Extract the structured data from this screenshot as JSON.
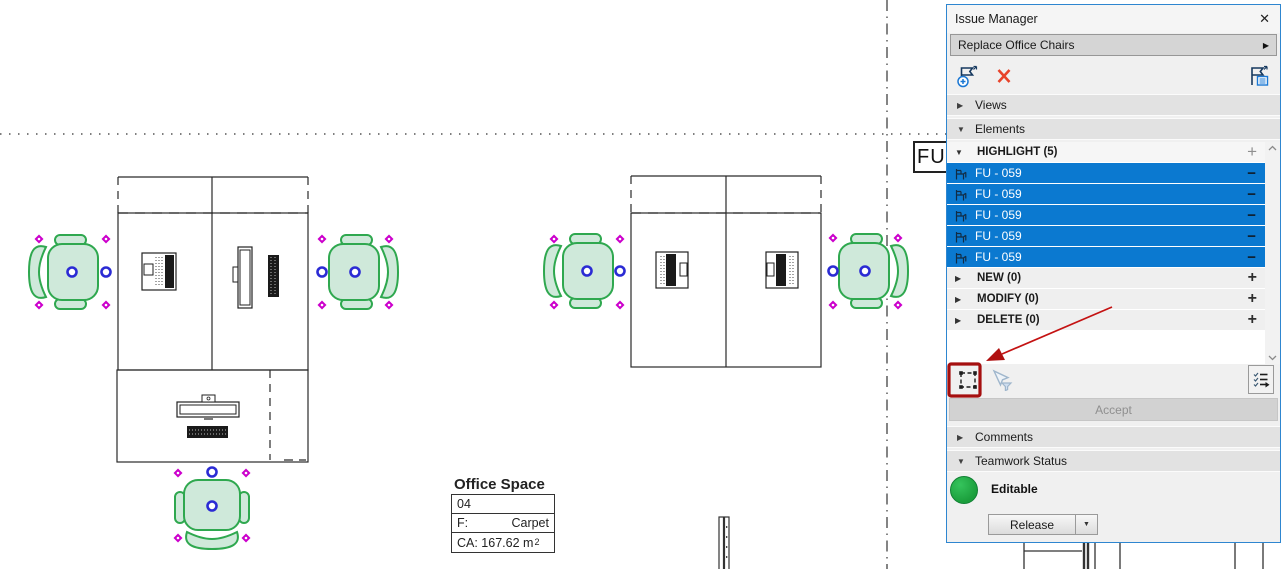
{
  "panel": {
    "title": "Issue Manager",
    "issue_name": "Replace Office Chairs",
    "sections": {
      "views": "Views",
      "elements": "Elements",
      "comments": "Comments",
      "teamwork": "Teamwork Status"
    },
    "elements_list": {
      "highlight_label": "HIGHLIGHT (5)",
      "items": [
        {
          "label": "FU - 059"
        },
        {
          "label": "FU - 059"
        },
        {
          "label": "FU - 059"
        },
        {
          "label": "FU - 059"
        },
        {
          "label": "FU - 059"
        }
      ],
      "new_label": "NEW (0)",
      "modify_label": "MODIFY (0)",
      "delete_label": "DELETE (0)"
    },
    "accept_label": "Accept",
    "teamwork_status": {
      "status": "Editable",
      "release": "Release"
    }
  },
  "glyphs": {
    "close": "✕",
    "collapsed": "▶",
    "expanded": "▼",
    "flyout": "▶",
    "plus": "+",
    "minus": "−",
    "dropdown": "▼"
  },
  "canvas": {
    "grid_label": "FU",
    "room": {
      "name": "Office Space",
      "number": "04",
      "finish_key": "F:",
      "finish_value": "Carpet",
      "area_text": "CA: 167.62 m",
      "area_sup": "2"
    }
  },
  "colors": {
    "selection_row_blue": "#0b79d0",
    "panel_border_blue": "#2e86d0",
    "chair_stroke_green": "#2fa84f",
    "chair_fill_green": "#cfe9da",
    "handle_magenta": "#cc00cc",
    "handle_blue": "#2b2bd4",
    "annotation_red": "#b01010",
    "status_green": "#1b9e3c"
  }
}
